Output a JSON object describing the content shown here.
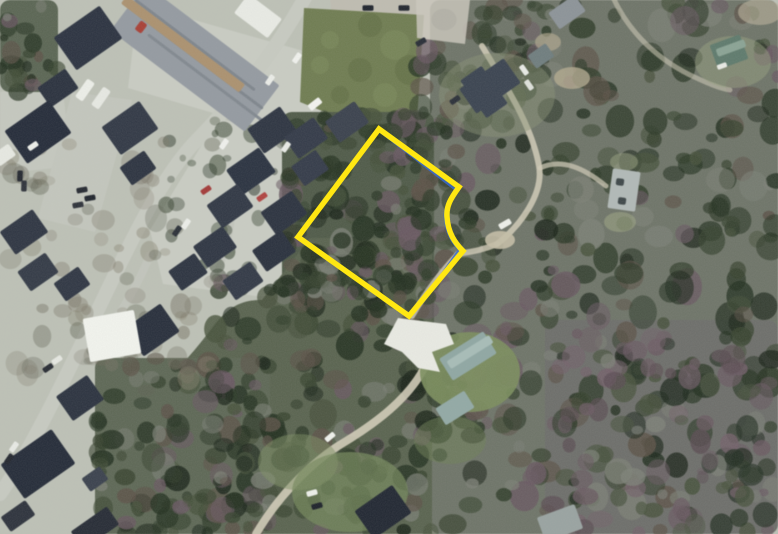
{
  "meta": {
    "description": "Aerial orthophoto with a highlighted property parcel boundary; suburban road and houses at left, dense woods at right",
    "image_type": "satellite-aerial-photo"
  },
  "canvas": {
    "width": 778,
    "height": 534
  },
  "palette": {
    "ground": "#bdc1b6",
    "road": "#c7cac1",
    "forest_base": "#6e7468",
    "parcel_outline": "#ffe712",
    "parcel_inner_line": "#3a6bcd",
    "grass_lot": "#6f7c51",
    "driveway_white": "#e9eae3",
    "dirt_path": "#d2ccb8"
  },
  "parcel": {
    "outline": {
      "d": "M379,129 L459,187 C451,198 446,206 447,217 C448,233 455,243 463,251 L409,316 L298,237 Z",
      "color": "#ffe712",
      "width": 5.5
    },
    "inner_line": {
      "d": "M382,133 L456,190 C449,200 444,208 445,218 C446,233 452,242 459,250 L420,305",
      "color": "#3a6bcd",
      "width": 2.4
    }
  },
  "scene": {
    "ground": "#bdc1b6",
    "dev_shapes": [
      {
        "type": "fill",
        "d": "M138,4 L342,62 L312,142 L128,88 Z",
        "fill": "#c9ccc3"
      },
      {
        "type": "fill",
        "d": "M330,-2 L432,-2 L430,22 L332,18 Z",
        "fill": "#bfbcb1"
      },
      {
        "type": "fill",
        "d": "M416,-2 L472,0 L466,46 L417,40 Z",
        "fill": "#c9c6bb"
      },
      {
        "type": "fill",
        "d": "M0,92 L62,84 L72,166 L0,174 Z",
        "fill": "#c5c8bf"
      },
      {
        "type": "fill",
        "d": "M72,92 L132,100 L95,232 L38,218 Z",
        "fill": "#c3c6bd"
      },
      {
        "type": "fill",
        "d": "M218,118 L332,150 L302,302 L163,284 L150,230 Z",
        "fill": "#c9ccc3"
      },
      {
        "type": "road",
        "d": "M307,-6 C272,58 232,104 196,141 C158,180 122,260 94,318 C68,372 30,452 0,494",
        "w": 14,
        "stroke": "#c7cac1"
      },
      {
        "type": "road",
        "d": "M232,215 C228,244 222,264 212,282",
        "w": 7,
        "stroke": "#c2c5bc"
      },
      {
        "type": "road",
        "d": "M150,255 C140,280 128,300 118,316",
        "w": 8,
        "stroke": "#c2c5bc"
      },
      {
        "type": "fill",
        "d": "M304,8 L424,15 L417,120 L347,121 L300,102 Z",
        "fill": "#6f7c51"
      }
    ],
    "grass_mottle": [
      [
        330,
        40
      ],
      [
        360,
        70
      ],
      [
        395,
        45
      ],
      [
        340,
        95
      ],
      [
        385,
        95
      ],
      [
        410,
        70
      ],
      [
        320,
        65
      ],
      [
        370,
        25
      ]
    ],
    "forest_bases": [
      {
        "r": [
          430,
          0,
          348,
          534
        ],
        "fill": "#6e7468",
        "o": 1
      },
      {
        "r": [
          545,
          320,
          233,
          214
        ],
        "fill": "#6d6a6b",
        "o": 0.55
      },
      {
        "r": [
          282,
          112,
          152,
          222
        ],
        "fill": "#4f5a48",
        "o": 1
      },
      {
        "d": "M310,238 L432,238 L432,534 L100,534 L95,432 C150,400 182,368 212,328 C230,304 244,300 262,300 Z",
        "fill": "#59634f",
        "o": 1
      },
      {
        "r": [
          95,
          358,
          175,
          176
        ],
        "fill": "#5d6755",
        "o": 1
      },
      {
        "r": [
          0,
          0,
          58,
          92
        ],
        "fill": "#5a6553",
        "o": 1
      }
    ],
    "palettes": {
      "dense": [
        "#233020",
        "#233020",
        "#2e3b29",
        "#2e3b29",
        "#1b251a",
        "#46513b",
        "#695962",
        "#7b7f75",
        "#5c5248",
        "#384430"
      ],
      "mauve": [
        "#6a5a62",
        "#5a4c52",
        "#73616a",
        "#243024",
        "#7d8178",
        "#4a5440",
        "#6a5a62"
      ],
      "dense2": [
        "#233020",
        "#2e3b29",
        "#384430",
        "#1b251a"
      ],
      "sparse": [
        "#6f6a5c",
        "#7d786a",
        "#5e6152",
        "#86816f"
      ]
    },
    "forest_regions": [
      [
        430,
        0,
        348,
        534,
        330,
        "dense",
        5,
        15,
        0.5,
        0.85
      ],
      [
        545,
        330,
        233,
        204,
        95,
        "mauve",
        5,
        13,
        0.45,
        0.8
      ],
      [
        282,
        112,
        152,
        222,
        135,
        "dense",
        5,
        13,
        0.5,
        0.85
      ],
      [
        210,
        270,
        222,
        264,
        150,
        "dense",
        5,
        14,
        0.5,
        0.85
      ],
      [
        300,
        238,
        130,
        60,
        40,
        "dense",
        5,
        12,
        0.5,
        0.8
      ],
      [
        95,
        358,
        175,
        176,
        115,
        "dense",
        5,
        13,
        0.5,
        0.85
      ],
      [
        0,
        0,
        58,
        92,
        24,
        "dense",
        4,
        11,
        0.5,
        0.8
      ],
      [
        416,
        46,
        56,
        200,
        48,
        "dense",
        4,
        12,
        0.5,
        0.8
      ],
      [
        470,
        0,
        95,
        70,
        30,
        "dense",
        4,
        11,
        0.45,
        0.75
      ],
      [
        165,
        118,
        165,
        175,
        42,
        "dense2",
        3,
        9,
        0.3,
        0.55
      ],
      [
        0,
        140,
        215,
        260,
        58,
        "sparse",
        5,
        12,
        0.22,
        0.42
      ],
      [
        60,
        300,
        140,
        80,
        25,
        "sparse",
        5,
        11,
        0.25,
        0.45
      ]
    ],
    "clearings": {
      "dirt_color": "#d2ccb8",
      "patches": [
        {
          "d": "M416,-2 L470,0 L465,44 L417,38 Z",
          "fill": "#c9c6bb",
          "o": 0.85
        }
      ],
      "dirt_paths": [
        {
          "d": "M482,46 C506,86 532,126 539,166 C544,194 520,226 497,244",
          "w": 6,
          "o": 0.85
        },
        {
          "d": "M497,244 C478,252 466,252 458,254 C441,272 426,292 412,316",
          "w": 6,
          "o": 0.8
        },
        {
          "d": "M540,168 C562,158 584,168 606,186",
          "w": 5,
          "o": 0.7
        },
        {
          "d": "M612,-5 C625,25 650,55 690,75 C705,82 718,88 730,90",
          "w": 5,
          "o": 0.55
        },
        {
          "d": "M428,360 C412,398 372,426 338,446 C306,467 276,500 256,534",
          "w": 8,
          "o": 0.9
        }
      ],
      "driveway": {
        "d": "M398,318 L446,324 L454,344 L432,352 L440,372 L418,368 L402,352 L384,344 Z",
        "fill": "#e9eae3"
      },
      "lawns": [
        [
          470,
          372,
          50,
          40,
          "#7b8e5d",
          0.9
        ],
        [
          497,
          95,
          58,
          42,
          "#8a9376",
          0.45
        ],
        [
          733,
          62,
          38,
          26,
          "#939e7e",
          0.5
        ],
        [
          350,
          492,
          58,
          40,
          "#73855b",
          0.75
        ],
        [
          298,
          462,
          40,
          28,
          "#7d8f63",
          0.5
        ],
        [
          450,
          440,
          36,
          24,
          "#6d7f55",
          0.5
        ],
        [
          572,
          78,
          18,
          11,
          "#b2a98f",
          0.8
        ],
        [
          548,
          42,
          13,
          9,
          "#b2a98f",
          0.65
        ],
        [
          500,
          240,
          15,
          9,
          "#c4bea6",
          0.9
        ],
        [
          760,
          12,
          22,
          13,
          "#b6ae98",
          0.65
        ],
        [
          620,
          222,
          16,
          10,
          "#9aa182",
          0.6
        ],
        [
          624,
          162,
          14,
          9,
          "#9aa182",
          0.5
        ]
      ]
    },
    "buildings": [
      [
        195,
        58,
        168,
        58,
        37,
        "#949aa1"
      ],
      [
        195,
        45,
        150,
        3,
        37,
        "#7e858c"
      ],
      [
        201,
        62,
        155,
        3,
        37,
        "#7e858c"
      ],
      [
        207,
        79,
        148,
        3,
        37,
        "#81888f"
      ],
      [
        183,
        44,
        148,
        10,
        37,
        "#ab916f"
      ],
      [
        141,
        27,
        8,
        11,
        37,
        "#a83f35"
      ],
      [
        258,
        16,
        42,
        24,
        37,
        "#e9ebe5"
      ],
      [
        88,
        38,
        56,
        40,
        -35,
        "#2b3240"
      ],
      [
        58,
        88,
        34,
        24,
        -35,
        "#2a313e"
      ],
      [
        38,
        132,
        54,
        40,
        -35,
        "#242b39"
      ],
      [
        130,
        128,
        46,
        34,
        -35,
        "#313845"
      ],
      [
        138,
        168,
        30,
        22,
        -35,
        "#2c3340"
      ],
      [
        4,
        155,
        20,
        14,
        -35,
        "#e7e9e2"
      ],
      [
        85,
        90,
        22,
        9,
        -55,
        "#edefe9"
      ],
      [
        101,
        98,
        22,
        9,
        -55,
        "#e7e9e3"
      ],
      [
        272,
        130,
        40,
        30,
        -35,
        "#2d3441"
      ],
      [
        306,
        138,
        36,
        26,
        -35,
        "#333a48"
      ],
      [
        347,
        122,
        36,
        26,
        -35,
        "#3a414d"
      ],
      [
        251,
        171,
        40,
        30,
        -35,
        "#2a3240"
      ],
      [
        310,
        168,
        30,
        24,
        -35,
        "#343b49"
      ],
      [
        230,
        206,
        38,
        28,
        -35,
        "#303744"
      ],
      [
        284,
        213,
        38,
        28,
        -35,
        "#2b323f"
      ],
      [
        215,
        247,
        36,
        26,
        -35,
        "#2e3542"
      ],
      [
        274,
        251,
        36,
        26,
        -35,
        "#29303d"
      ],
      [
        243,
        281,
        34,
        24,
        -35,
        "#323946"
      ],
      [
        188,
        272,
        32,
        24,
        -35,
        "#2c3340"
      ],
      [
        24,
        232,
        40,
        28,
        -35,
        "#2e3542"
      ],
      [
        38,
        272,
        34,
        24,
        -35,
        "#333a46"
      ],
      [
        72,
        284,
        30,
        22,
        -35,
        "#2f3643"
      ],
      [
        152,
        330,
        44,
        34,
        -35,
        "#272e3b"
      ],
      [
        112,
        336,
        52,
        44,
        -10,
        "#f2f4ee"
      ],
      [
        80,
        398,
        38,
        30,
        -35,
        "#2b323f"
      ],
      [
        38,
        464,
        62,
        42,
        -35,
        "#242b38"
      ],
      [
        95,
        479,
        22,
        16,
        -35,
        "#3a414d"
      ],
      [
        95,
        528,
        44,
        22,
        -35,
        "#262b35"
      ],
      [
        18,
        516,
        30,
        18,
        -35,
        "#2d323c"
      ],
      [
        383,
        512,
        46,
        34,
        -35,
        "#212732"
      ],
      [
        560,
        523,
        40,
        26,
        -20,
        "#99a3a1"
      ],
      [
        490,
        86,
        54,
        30,
        -35,
        "#3a4350"
      ],
      [
        484,
        92,
        26,
        46,
        -35,
        "#3a4350"
      ],
      [
        541,
        56,
        22,
        16,
        -35,
        "#6f7d7e"
      ],
      [
        567,
        12,
        32,
        20,
        -35,
        "#8c9398"
      ],
      [
        729,
        52,
        32,
        26,
        -20,
        "#5e7a6c"
      ],
      [
        731,
        48,
        30,
        8,
        -20,
        "#8aa394"
      ],
      [
        624,
        190,
        28,
        40,
        8,
        "#b1b9b7"
      ],
      [
        620,
        182,
        8,
        7,
        8,
        "#3d4648"
      ],
      [
        622,
        201,
        8,
        7,
        8,
        "#3d4648"
      ],
      [
        468,
        356,
        52,
        26,
        -32,
        "#8fa7a3"
      ],
      [
        470,
        352,
        50,
        9,
        -32,
        "#a7bcb7"
      ],
      [
        455,
        408,
        34,
        20,
        -32,
        "#92a9a5"
      ]
    ],
    "vehicles": [
      [
        297,
        58,
        -55,
        "#f1f2ee"
      ],
      [
        270,
        80,
        -55,
        "#ebede8"
      ],
      [
        315,
        104,
        -38,
        "#f3f4f0",
        14,
        7
      ],
      [
        368,
        8,
        0,
        "#1d222b"
      ],
      [
        404,
        8,
        0,
        "#20252e"
      ],
      [
        421,
        42,
        -30,
        "#272c35"
      ],
      [
        455,
        100,
        -35,
        "#2a2f38"
      ],
      [
        524,
        70,
        55,
        "#e9ebe6"
      ],
      [
        529,
        85,
        55,
        "#dfe2dc"
      ],
      [
        505,
        224,
        -30,
        "#eef0ea",
        13,
        6
      ],
      [
        224,
        144,
        -55,
        "#f0f1ed"
      ],
      [
        286,
        147,
        -55,
        "#e9ebe6"
      ],
      [
        206,
        190,
        -35,
        "#a33a38"
      ],
      [
        262,
        197,
        -35,
        "#b04340"
      ],
      [
        186,
        224,
        -55,
        "#eceee9"
      ],
      [
        177,
        231,
        -55,
        "#2a2f37"
      ],
      [
        33,
        146,
        -35,
        "#eef0eb"
      ],
      [
        82,
        190,
        -10,
        "#23272f"
      ],
      [
        78,
        205,
        -10,
        "#2d3139"
      ],
      [
        90,
        198,
        -10,
        "#1f242c"
      ],
      [
        20,
        176,
        -88,
        "#23272f"
      ],
      [
        24,
        186,
        -88,
        "#2e323a"
      ],
      [
        48,
        368,
        -35,
        "#272b33"
      ],
      [
        57,
        360,
        -35,
        "#e6e8e2"
      ],
      [
        330,
        437,
        -40,
        "#f0f2ed"
      ],
      [
        312,
        493,
        -15,
        "#eef0ea"
      ],
      [
        317,
        506,
        -15,
        "#1c2129"
      ],
      [
        14,
        447,
        -55,
        "#e8eae5"
      ],
      [
        9,
        459,
        -55,
        "#23272f"
      ],
      [
        722,
        66,
        -20,
        "#e8eae4",
        10,
        5
      ]
    ]
  }
}
